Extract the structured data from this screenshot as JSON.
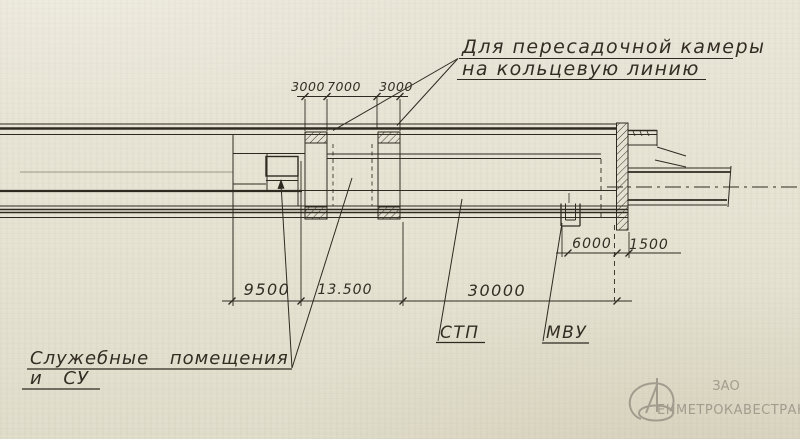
{
  "note": {
    "line1": "Для пересадочной камеры",
    "line2": "на кольцевую линию"
  },
  "dims": {
    "top": [
      "3000",
      "7000",
      "3000"
    ],
    "bottom": [
      "9500",
      "13.500",
      "30000"
    ],
    "right": [
      "6000",
      "1500"
    ]
  },
  "labels": {
    "stp": "СТП",
    "mvu": "МВУ",
    "service1": "Служебные помещения",
    "service2": "и СУ"
  },
  "watermark": {
    "org_form": "ЗАО",
    "name": "ЕНМЕТРОКАВЕСТРАНС"
  },
  "colors": {
    "paper": "#e7e4d5",
    "ink": "#2f2a21",
    "watermark_gray": "#a29c8e"
  }
}
